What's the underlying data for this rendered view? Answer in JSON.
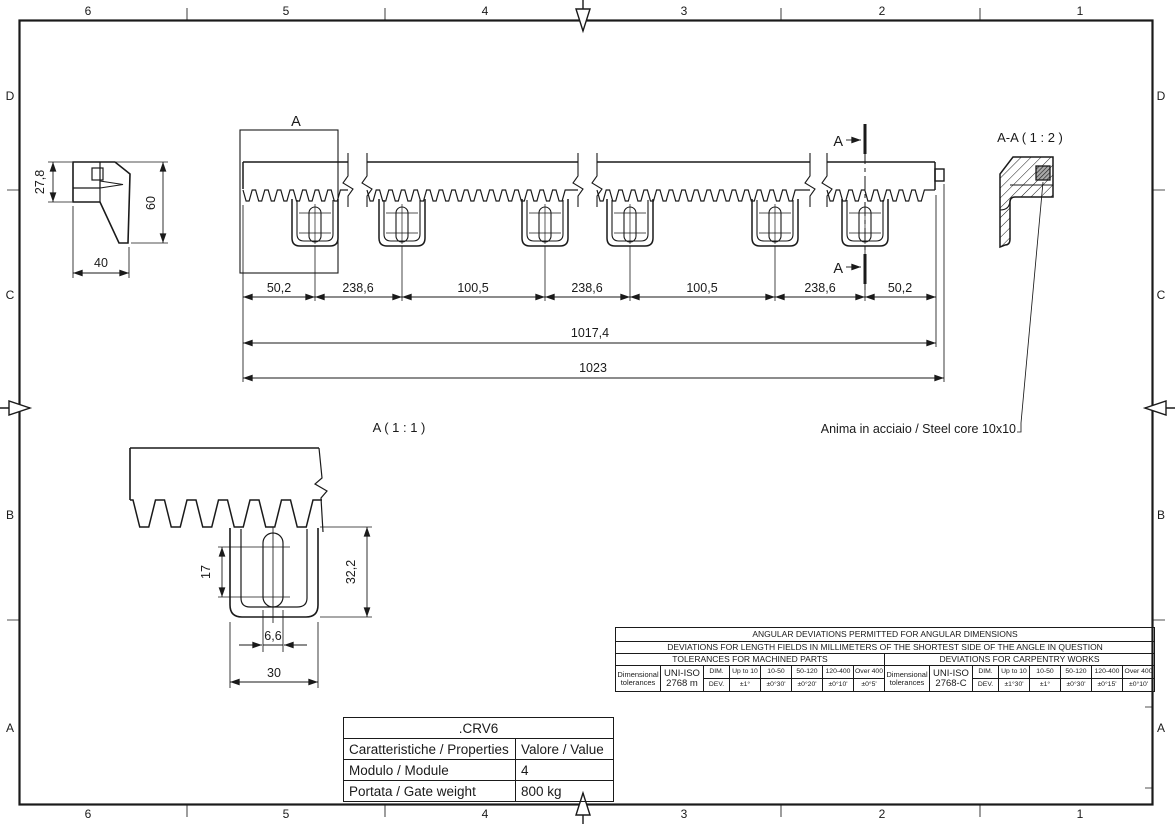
{
  "frame": {
    "top_columns": [
      "6",
      "5",
      "4",
      "3",
      "2",
      "1"
    ],
    "bottom_columns": [
      "6",
      "5",
      "4",
      "3",
      "2",
      "1"
    ],
    "left_rows": [
      "D",
      "C",
      "B",
      "A"
    ],
    "right_rows": [
      "D",
      "C",
      "B",
      "A"
    ]
  },
  "side_view": {
    "dim_height_upper": "27,8",
    "dim_height_total": "60",
    "dim_width": "40"
  },
  "main_view": {
    "detail_marker": "A",
    "section_marker_top": "A",
    "section_marker_bottom": "A",
    "dim_chain": [
      "50,2",
      "238,6",
      "100,5",
      "238,6",
      "100,5",
      "238,6",
      "50,2"
    ],
    "dim_toothed_length": "1017,4",
    "dim_overall_length": "1023"
  },
  "section_view": {
    "title": "A-A ( 1 : 2 )",
    "core_note": "Anima in acciaio / Steel core 10x10"
  },
  "detail_view": {
    "title": "A ( 1 : 1 )",
    "dim_slot_length": "17",
    "dim_lug_height": "32,2",
    "dim_slot_width": "6,6",
    "dim_lug_width": "30"
  },
  "tolerance_table": {
    "row1": "ANGULAR DEVIATIONS PERMITTED FOR ANGULAR DIMENSIONS",
    "row2": "DEVIATIONS FOR LENGTH FIELDS IN MILLIMETERS OF THE SHORTEST SIDE OF THE ANGLE IN QUESTION",
    "machined": {
      "header": "TOLERANCES FOR MACHINED PARTS",
      "label": "Dimensional tolerances",
      "standard": [
        "UNI-ISO",
        "2768 m"
      ],
      "dim_label": "DIM.",
      "dev_label": "DEV.",
      "dims": [
        "Up to 10",
        "10-50",
        "50-120",
        "120-400",
        "Over 400"
      ],
      "devs": [
        "±1°",
        "±0°30'",
        "±0°20'",
        "±0°10'",
        "±0°5'"
      ]
    },
    "carpentry": {
      "header": "DEVIATIONS FOR CARPENTRY WORKS",
      "label": "Dimensional tolerances",
      "standard": [
        "UNI-ISO",
        "2768-C"
      ],
      "dim_label": "DIM.",
      "dev_label": "DEV.",
      "dims": [
        "Up to 10",
        "10-50",
        "50-120",
        "120-400",
        "Over 400"
      ],
      "devs": [
        "±1°30'",
        "±1°",
        "±0°30'",
        "±0°15'",
        "±0°10'"
      ]
    }
  },
  "properties_table": {
    "title": ".CRV6",
    "col_property": "Caratteristiche / Properties",
    "col_value": "Valore / Value",
    "rows": [
      {
        "property": "Modulo / Module",
        "value": "4"
      },
      {
        "property": "Portata / Gate weight",
        "value": "800 kg"
      }
    ]
  }
}
